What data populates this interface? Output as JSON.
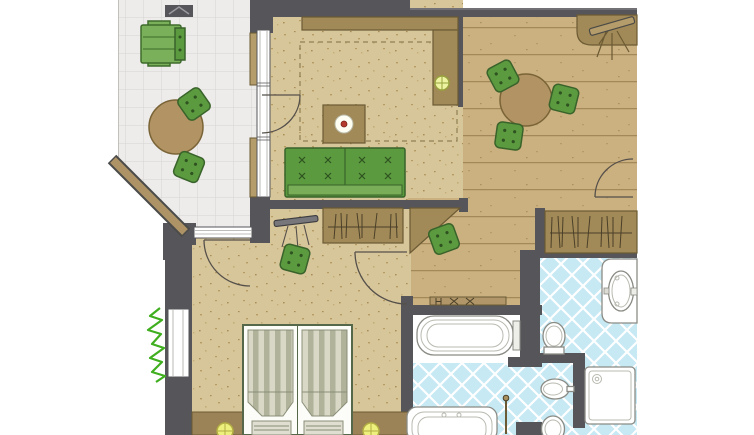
{
  "document": {
    "type": "architectural-floor-plan",
    "title": "Hotel suite floor plan with terrace, living-dining area, bedroom and bathroom",
    "visible_text": []
  },
  "palette": {
    "background": "#ffffff",
    "wall": "#56565a",
    "terrace_tile": "#edeceb",
    "terrace_tile_line": "#d8d4d0",
    "carpet": "#d8c69b",
    "carpet_speckle": "#b69c62",
    "wood_plank": "#cbb080",
    "wood_plank_line": "#a3895a",
    "bath_tile": "#c6e9f4",
    "bath_tile_line": "#ffffff",
    "cabinet_wood": "#a28a58",
    "cabinet_edge": "#6b5a33",
    "table_wood": "#b29464",
    "furniture_green": "#5c9a40",
    "furniture_green_edge": "#39632a",
    "sofa_seat_green": "#79ad57",
    "lounger_green": "#7ab05a",
    "fixture_white": "#ffffff",
    "fixture_line": "#8b8b85",
    "lamp_yellow": "#eef07d",
    "ceiling_light": "#eef3a2",
    "plant_green": "#3fae1f",
    "mattress_light": "#d9d8c7",
    "mattress_dark": "#b0b299",
    "bed_frame_edge": "#55684a",
    "accent_red": "#b43a2e"
  },
  "rooms": [
    {
      "name": "terrace",
      "floor": "ceramic-tile-grid",
      "furniture": [
        "sun-lounger",
        "round-table",
        "garden-chair",
        "garden-chair",
        "diagonal-railing"
      ]
    },
    {
      "name": "living-room",
      "floor": "speckled-carpet",
      "furniture": [
        "sideboard",
        "cabinet-column",
        "ceiling-light",
        "rug",
        "coffee-table",
        "plate-with-apple",
        "two-seat-sofa"
      ]
    },
    {
      "name": "dining-room",
      "floor": "wood-planks",
      "furniture": [
        "corner-counter",
        "coat-stand",
        "round-dining-table",
        "dining-chair",
        "dining-chair",
        "dining-chair"
      ]
    },
    {
      "name": "hallway",
      "floor": "wood-planks",
      "furniture": [
        "built-in-wardrobe",
        "coat-stand",
        "angled-cabinet",
        "stool",
        "wardrobe-with-clothes"
      ]
    },
    {
      "name": "bedroom",
      "floor": "speckled-carpet",
      "furniture": [
        "twin-bed",
        "duvet",
        "duvet",
        "pillow",
        "pillow",
        "headboard-console",
        "bedside-lamp",
        "bedside-lamp",
        "stool",
        "wall-plant",
        "towel-radiator"
      ]
    },
    {
      "name": "bathroom",
      "floor": "blue-diamond-tiles",
      "fixtures": [
        "bathtub",
        "washbasin-counter",
        "toilet",
        "bidet",
        "toilet-second",
        "shower-tray",
        "second-bathtub",
        "shower-pole"
      ]
    }
  ],
  "doors": [
    {
      "from": "terrace",
      "to": "living-room",
      "type": "swing"
    },
    {
      "from": "terrace",
      "to": "bedroom",
      "type": "swing"
    },
    {
      "from": "hallway",
      "to": "bedroom",
      "type": "swing"
    },
    {
      "from": "dining-room",
      "to": "adjacent-space-right",
      "type": "swing"
    }
  ],
  "windows": [
    "terrace-living-window",
    "terrace-bedroom-window",
    "bedroom-side-window"
  ],
  "counts": {
    "green-seats": 8,
    "round-tables": 2,
    "lamps": 3,
    "sanitary-fixtures": 7
  }
}
